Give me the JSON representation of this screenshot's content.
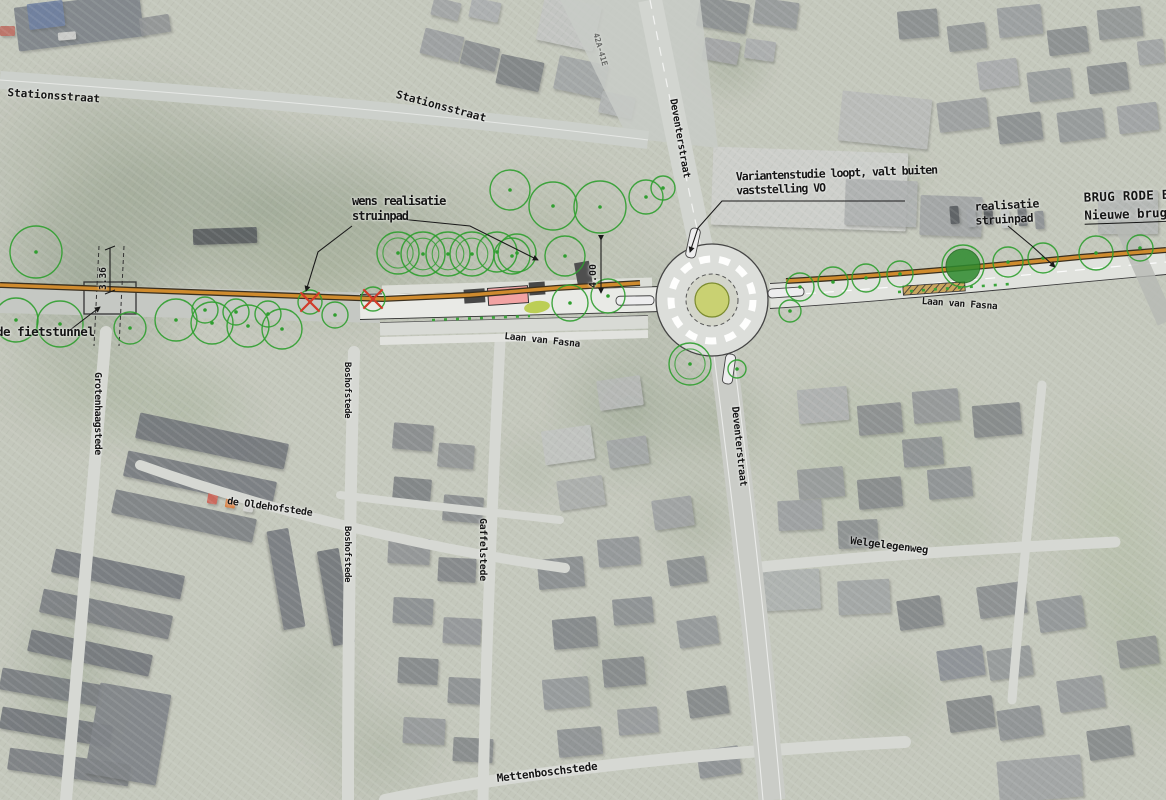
{
  "labels": {
    "stationsstraat_left": "Stationsstraat",
    "stationsstraat_mid": "Stationsstraat",
    "grotenhaagstede": "Grotenhaagstede",
    "oldehofstede": "de Oldehofstede",
    "boshofstede_1": "Boshofstede",
    "boshofstede_2": "Boshofstede",
    "gaffelstede": "Gaffelstede",
    "laan_van_fasna_1": "Laan van Fasna",
    "laan_van_fasna_2": "Laan van Fasna",
    "deventerstraat_1": "Deventerstraat",
    "deventerstraat_2": "Deventerstraat",
    "welgelegenweg": "Welgelegenweg",
    "mettenboschstede": "Mettenboschstede",
    "fietstunnel": "de fietstunnel",
    "house_numbers": "42A-41E"
  },
  "annotations": {
    "wens_line1": "wens realisatie",
    "wens_line2": "struinpad",
    "variantenstudie_line1": "Variantenstudie loopt, valt buiten",
    "variantenstudie_line2": "vaststelling VO",
    "realisatie_line1": "realisatie",
    "realisatie_line2": "struinpad",
    "brug_title": "BRUG RODE BEE",
    "brug_subtitle": "Nieuwe brug"
  },
  "dimensions": {
    "tunnel_width": "3.36",
    "path_width": "4.00"
  },
  "colors": {
    "tree_outline": "#2f9e2f",
    "tree_filled": "#2e8b2e",
    "removed_tree_cross": "#d23b2a",
    "struinpad_orange": "#cf8b2e",
    "plateau_pink": "#f2a3a3",
    "roundabout_center": "#c9d172",
    "annotation_ink": "#1a1a1a"
  }
}
